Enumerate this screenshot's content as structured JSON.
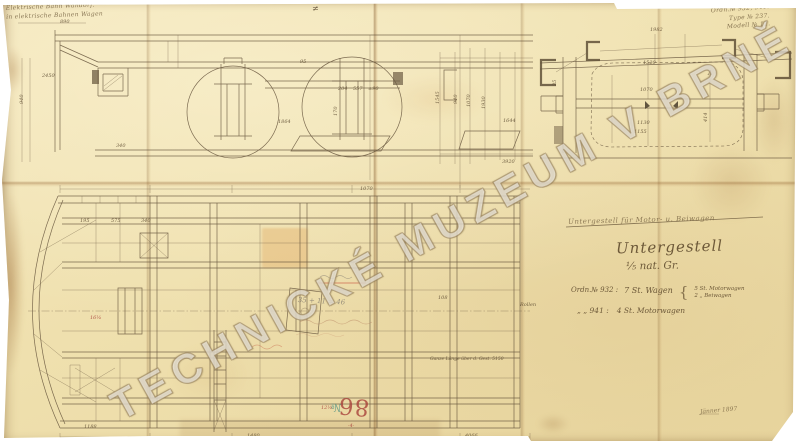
{
  "colors": {
    "paper": "#efe0ad",
    "ink": "#5c4a30",
    "red_stamp": "#a8413a",
    "teal": "#37877e",
    "pencil": "#8a8274",
    "red_ink": "#c0392b"
  },
  "watermark": "TECHNICKÉ MUZEUM V BRNĚ",
  "corner_notes": {
    "top_left": [
      "Elektrische Bahn Wandorf.",
      "in elektrische Bahnen Wagen"
    ],
    "top_right": [
      "Ordn.№ 932, 941.",
      "Type № 237.",
      "Modell № 11."
    ],
    "date": "Jänner 1897"
  },
  "title_block": {
    "struck_line": "Untergestell für Motor- u. Beiwagen",
    "title": "Untergestell",
    "scale": "⅕ nat. Gr.",
    "brace": "{",
    "orders": [
      {
        "label": "Ordn.№ 932 :",
        "value": "7 St. Wagen",
        "detail1": "5 St. Motorwagen",
        "detail2": "2  „  Beiwagen"
      },
      {
        "label": "„    „  941 :",
        "value": "4 St. Motorwagen"
      }
    ]
  },
  "stamp": {
    "number": "86",
    "mark": "№"
  },
  "dim_labels": [
    {
      "x": 60,
      "y": 20,
      "t": "890"
    },
    {
      "x": 42,
      "y": 74,
      "t": "2450"
    },
    {
      "x": 20,
      "y": 104,
      "t": "940",
      "r": 90
    },
    {
      "x": 338,
      "y": 87,
      "t": "204"
    },
    {
      "x": 353,
      "y": 87,
      "t": "557"
    },
    {
      "x": 368,
      "y": 87,
      "t": "±90"
    },
    {
      "x": 334,
      "y": 116,
      "t": "170",
      "r": 90
    },
    {
      "x": 278,
      "y": 120,
      "t": "1864"
    },
    {
      "x": 503,
      "y": 119,
      "t": "1644"
    },
    {
      "x": 502,
      "y": 160,
      "t": "3920"
    },
    {
      "x": 436,
      "y": 104,
      "t": "1545",
      "r": 90
    },
    {
      "x": 454,
      "y": 104,
      "t": "940",
      "r": 90
    },
    {
      "x": 467,
      "y": 107,
      "t": "1070",
      "r": 90
    },
    {
      "x": 482,
      "y": 109,
      "t": "1930",
      "r": 90
    },
    {
      "x": 116,
      "y": 144,
      "t": "340"
    },
    {
      "x": 300,
      "y": 60,
      "t": "95"
    },
    {
      "x": 650,
      "y": 28,
      "t": "1982"
    },
    {
      "x": 643,
      "y": 61,
      "t": "1520"
    },
    {
      "x": 640,
      "y": 88,
      "t": "1070"
    },
    {
      "x": 637,
      "y": 121,
      "t": "1130"
    },
    {
      "x": 634,
      "y": 130,
      "t": "1155"
    },
    {
      "x": 704,
      "y": 122,
      "t": "414",
      "r": 90
    },
    {
      "x": 708,
      "y": 71,
      "t": "A",
      "f": 6
    },
    {
      "x": 553,
      "y": 86,
      "t": "35",
      "r": 90
    },
    {
      "x": 80,
      "y": 219,
      "t": "195"
    },
    {
      "x": 111,
      "y": 219,
      "t": "575"
    },
    {
      "x": 141,
      "y": 219,
      "t": "340"
    },
    {
      "x": 84,
      "y": 425,
      "t": "1188"
    },
    {
      "x": 247,
      "y": 434,
      "t": "1480"
    },
    {
      "x": 360,
      "y": 187,
      "t": "1070"
    },
    {
      "x": 438,
      "y": 296,
      "t": "108"
    },
    {
      "x": 465,
      "y": 434,
      "t": "4066"
    },
    {
      "x": 90,
      "y": 316,
      "t": "16¼",
      "c": "#a8413a"
    },
    {
      "x": 312,
      "y": 5,
      "t": "≠",
      "f": 8
    },
    {
      "x": 430,
      "y": 358,
      "t": "Ganze Länge über d. Gest. 5150",
      "f": 4.5
    },
    {
      "x": 520,
      "y": 303,
      "t": "Rollen",
      "f": 5
    },
    {
      "x": 298,
      "y": 297,
      "t": "35 + 11 = 46",
      "c": "#8a8274",
      "f": 7,
      "r": -3
    },
    {
      "x": 321,
      "y": 406,
      "t": "12¼",
      "c": "#a8413a",
      "f": 5
    },
    {
      "x": 348,
      "y": 424,
      "t": "·4·",
      "c": "#a8413a",
      "f": 5
    }
  ]
}
